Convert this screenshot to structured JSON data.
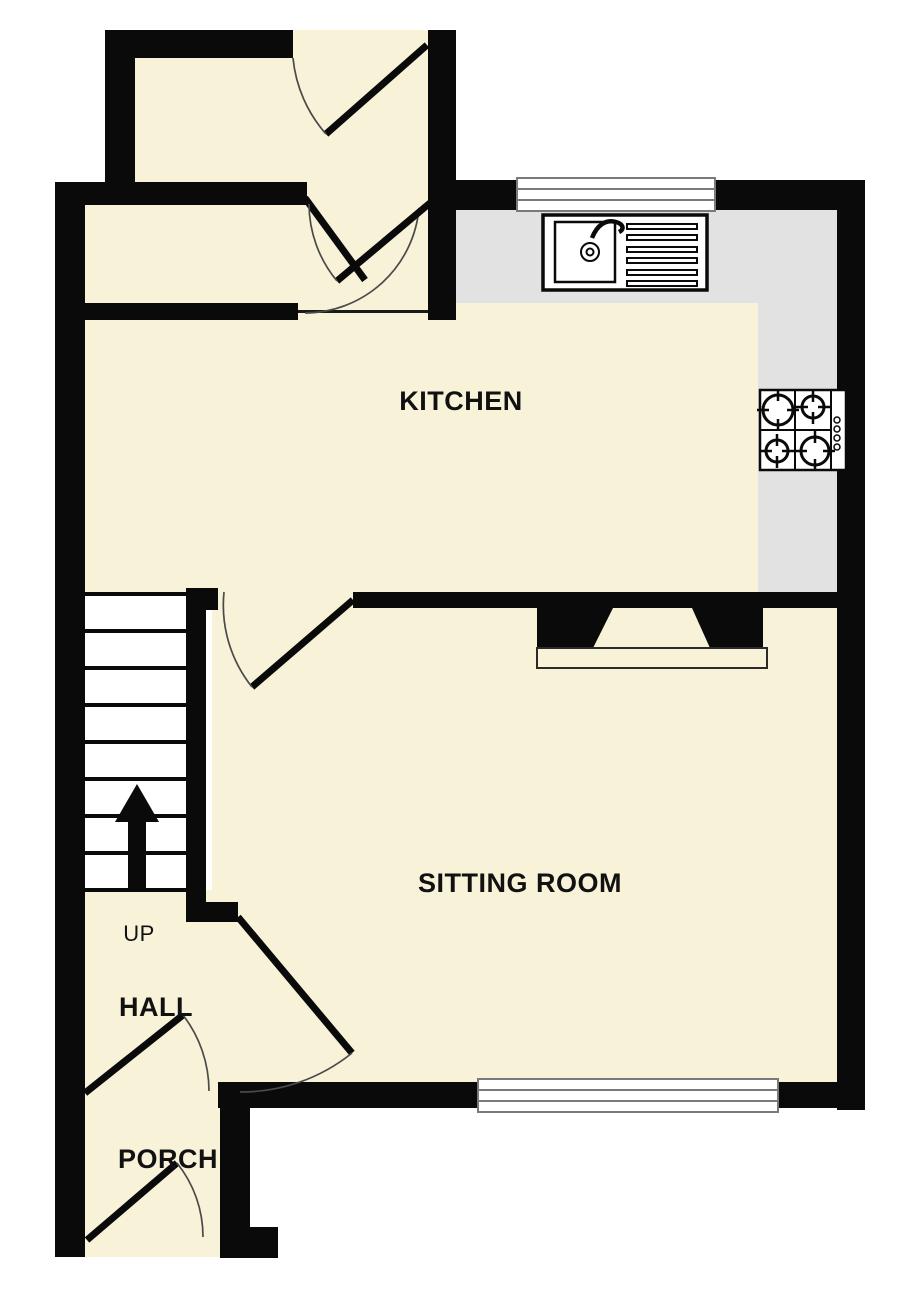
{
  "labels": {
    "kitchen": "KITCHEN",
    "sitting_room": "SITTING ROOM",
    "hall": "HALL",
    "porch": "PORCH",
    "stairs_direction": "UP"
  },
  "palette": {
    "paper": "#ffffff",
    "floor_fill": "#f7f2d8",
    "worktop_fill": "#e2e2e2",
    "wall": "#0a0a0a",
    "door_arc": "#4a4a4a",
    "window_frame": "#7a7a7a",
    "label_text": "#111111"
  },
  "fixtures": {
    "kitchen_sink": "sink-with-drainer-icon",
    "hob": "four-burner-hob-icon",
    "fireplace": "chimney-breast-hearth-icon",
    "stairs": "staircase-up-arrow-icon",
    "stair_tread_count": 8,
    "window_count": 2,
    "door_count": 7
  }
}
